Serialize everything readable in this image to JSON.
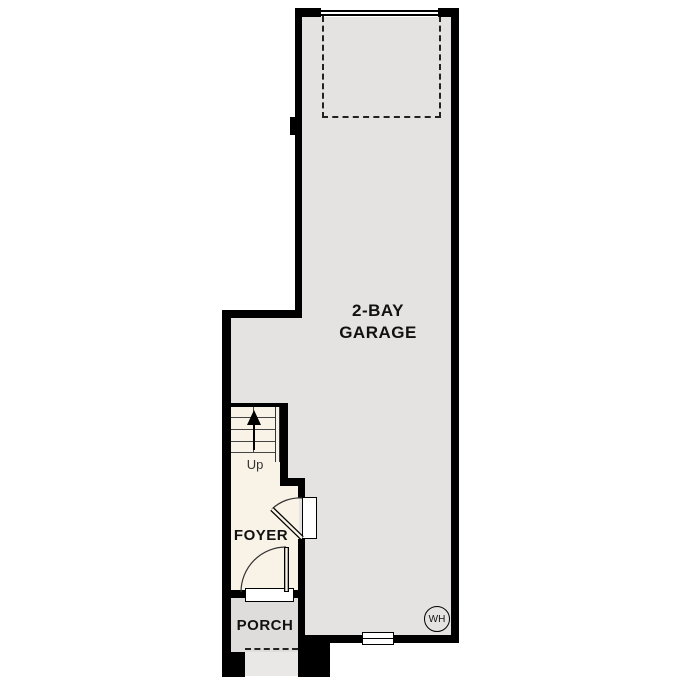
{
  "plan_type": "first-floor-plan",
  "rooms": {
    "garage": {
      "name": "2-BAY GARAGE",
      "label_lines": [
        "2-BAY",
        "GARAGE"
      ]
    },
    "foyer": {
      "label": "FOYER"
    },
    "porch": {
      "label": "PORCH"
    }
  },
  "stairs": {
    "direction_label": "Up"
  },
  "fixtures": {
    "water_heater": {
      "label": "WH"
    }
  },
  "colors": {
    "wall": "#000000",
    "garage_floor": "#e4e3e1",
    "interior_floor": "#f9f2e7",
    "porch_floor": "#dedddb",
    "step": "#e9e8e6",
    "background": "#ffffff"
  }
}
